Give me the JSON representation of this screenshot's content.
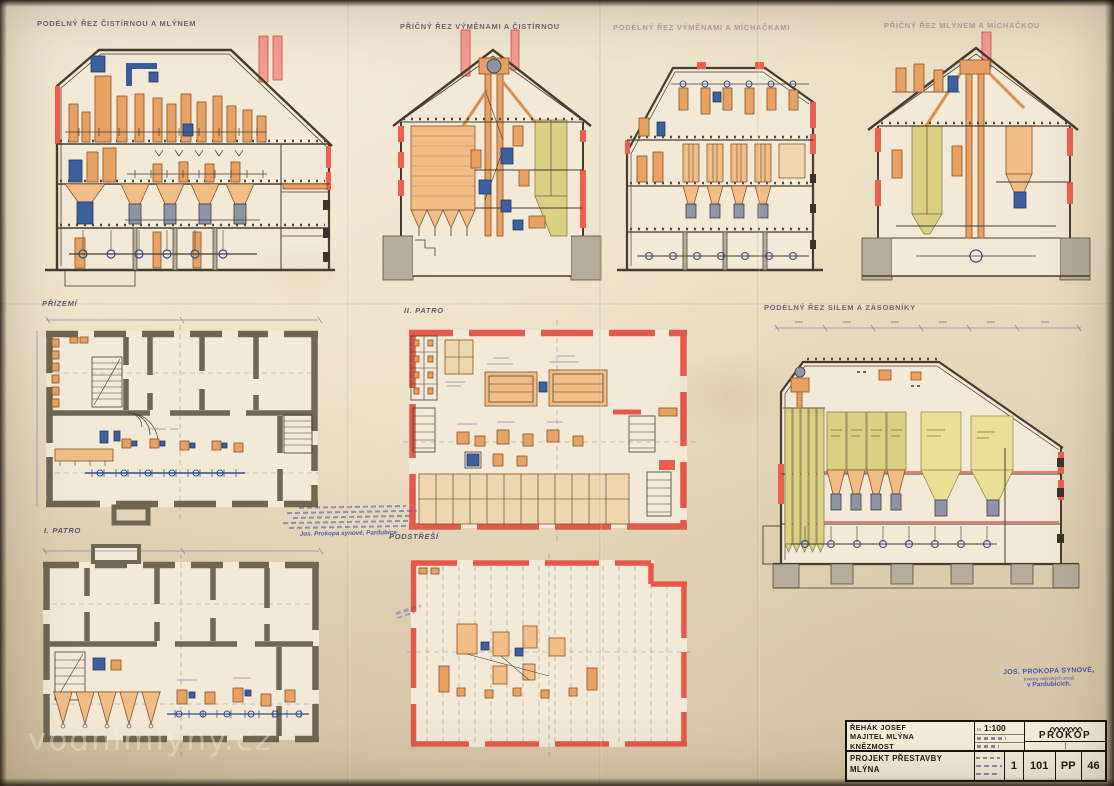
{
  "document": {
    "labels": {
      "section1": "PODÉLNÝ ŘEZ ČISTÍRNOU A MLÝNEM",
      "section2": "PŘÍČNÝ ŘEZ VÝMĚNAMI A ČISTÍRNOU",
      "section3": "PODÉLNÝ ŘEZ VÝMĚNAMI A MÍCHAČKAMI",
      "section4": "PŘÍČNÝ ŘEZ MLÝNEM A MÍCHAČKOU",
      "plan_ground": "PŘÍZEMÍ",
      "plan_first_floor": "I. PATRO",
      "plan_second_floor": "II. PATRO",
      "plan_attic": "PODSTŘEŠÍ",
      "section_silo": "PODÉLNÝ ŘEZ SILEM A ZÁSOBNÍKY"
    },
    "title_block": {
      "owner_name": "ŘEHÁK JOSEF",
      "owner_role": "MAJITEL MLÝNA",
      "owner_town": "KNĚZMOST",
      "scale_label": "M.",
      "scale_value": "1:100",
      "company_name": "PROKOP",
      "project_title_line1": "PROJEKT PŘESTAVBY",
      "project_title_line2": "MLÝNA",
      "sheet_number": "1",
      "drawing_number": "101",
      "series_code": "PP",
      "file_number": "46"
    },
    "stamps": {
      "maker_line1": "JOS. PROKOPA SYNOVÉ,",
      "maker_line2": "továrny mlýnských strojů",
      "maker_line3": "v Pardubicích.",
      "note_signature": "Jos. Prokopa synové, Pardubice"
    },
    "watermark": "vodnimlyny.cz",
    "colors": {
      "paper": "#e9dcc0",
      "ink": "#473c30",
      "red_accent": "#ee5f50",
      "machine_orange": "#e7a263",
      "machine_blue": "#3d5f9e",
      "silo_green": "#d9d083",
      "wall_gray": "#6f6753",
      "stamp_blue": "#3f4aa8"
    }
  }
}
